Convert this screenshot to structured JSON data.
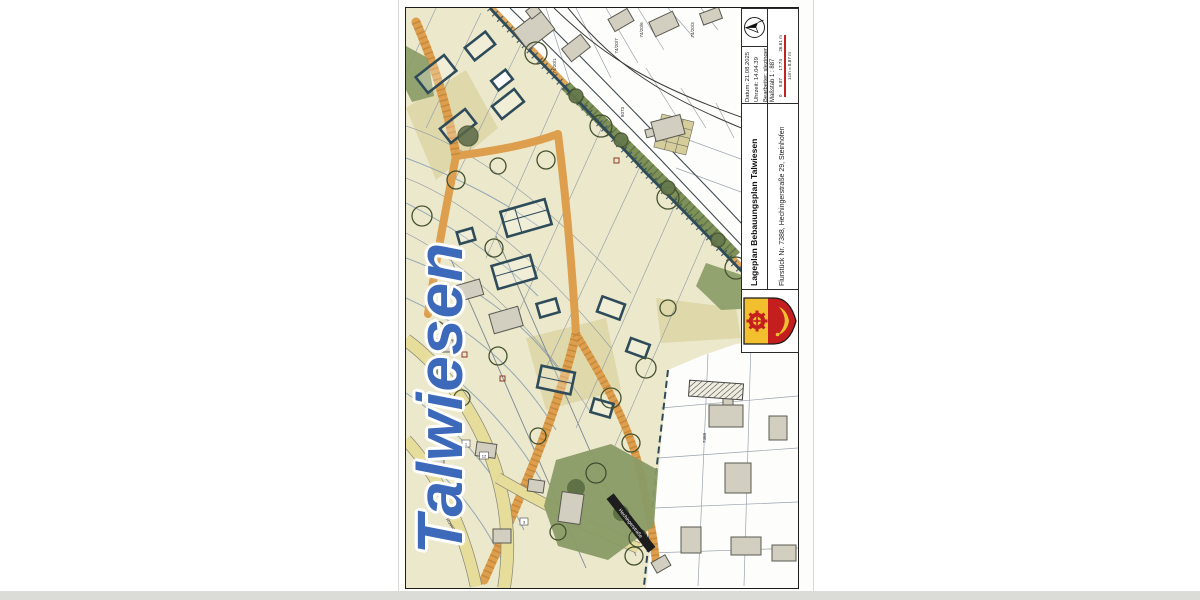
{
  "document": {
    "watermark": "Talwiesen",
    "kind": "Gescannter Lageplan (Bebauungsplan)"
  },
  "title_block": {
    "north_arrow_icon": "north-arrow",
    "crest_icon": "municipal-coat-of-arms",
    "datum": "Datum: 21.08.2025",
    "uhrzeit": "Uhrzeit: 14.04.39",
    "bearbeiter": "Bearbeiter: slezinger",
    "massstab": "Maßstab 1 : 887",
    "scale_ticks": [
      "0",
      "8.87",
      "17.74",
      "26.61 m"
    ],
    "scale_note": "1cm = 8.87 m",
    "scale_bar_color": "#c22222",
    "title": "Lageplan Bebauungsplan Talwiesen",
    "subtitle": "Flurstück Nr. 7388, Hechingerstraße 29, Steinhofen"
  },
  "map": {
    "parcel_labels": [
      "74/20/1",
      "74/20/7",
      "74/20/6",
      "74/20/3",
      "8073",
      "7388"
    ],
    "street_labels": {
      "rosengasse": "Rosengasse",
      "hechingerstrasse": "Hechingerstraße"
    },
    "house_numbers": [
      "1",
      "12",
      "3"
    ],
    "colors": {
      "plan_area": "#ece8cb",
      "existing_area": "#fdfdfb",
      "planned_street_orange": "#dd9f4d",
      "green_space": "#8a9b66",
      "building_outline_navy": "#2e4b5a",
      "existing_building_gray": "#d2cec0",
      "existing_road_yellow": "#e7dd9b",
      "watermark_blue": "#2d5cb5"
    }
  }
}
